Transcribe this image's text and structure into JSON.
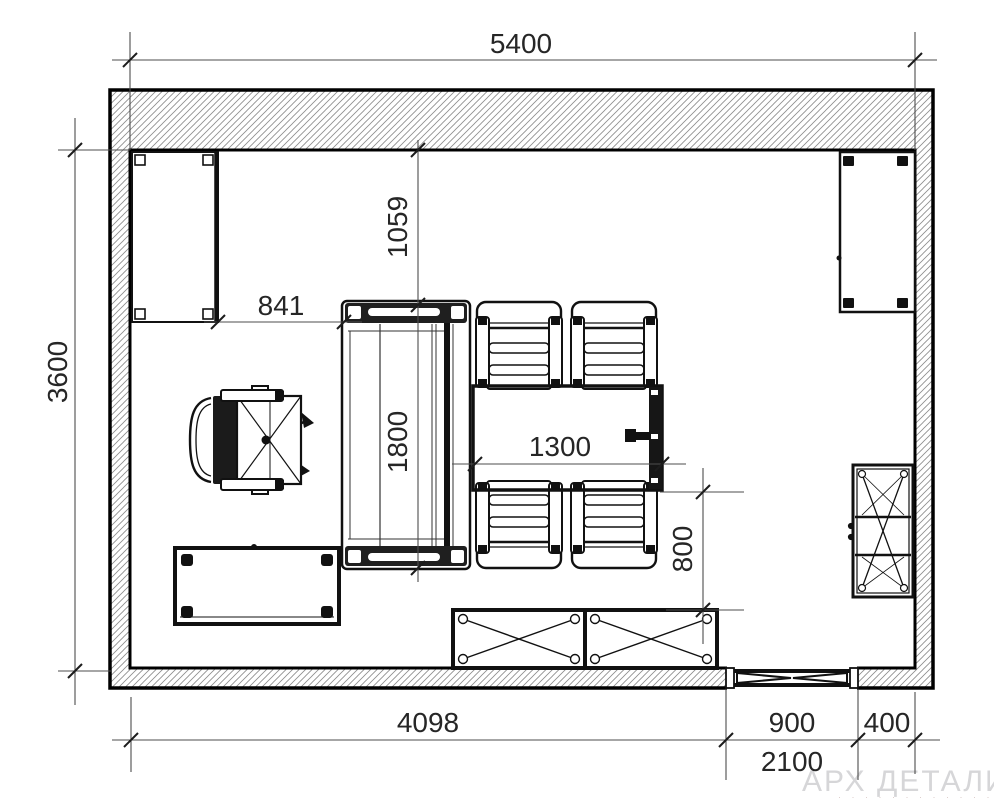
{
  "plan": {
    "title": "room-floor-plan",
    "units": "mm",
    "dims": {
      "room_width": "5400",
      "room_depth": "3600",
      "wardrobe_to_sofa": "841",
      "wall_to_sofa": "1059",
      "sofa_length": "1800",
      "table_length": "1300",
      "table_to_sideboard": "800",
      "wall_to_door": "4098",
      "door_width": "900",
      "door_to_wall": "400",
      "door_height": "2100"
    },
    "furniture": [
      "wardrobe-top-left",
      "desk-chair",
      "coffee-table",
      "sofa",
      "dining-table",
      "dining-chair-1",
      "dining-chair-2",
      "dining-chair-3",
      "dining-chair-4",
      "sideboard",
      "cabinet-top-right",
      "shelf-cabinet-right",
      "door-opening"
    ],
    "watermark": {
      "title": "АРХ ДЕТАЛИ",
      "subtitle": "· · · · · · · · · · · ·"
    }
  }
}
